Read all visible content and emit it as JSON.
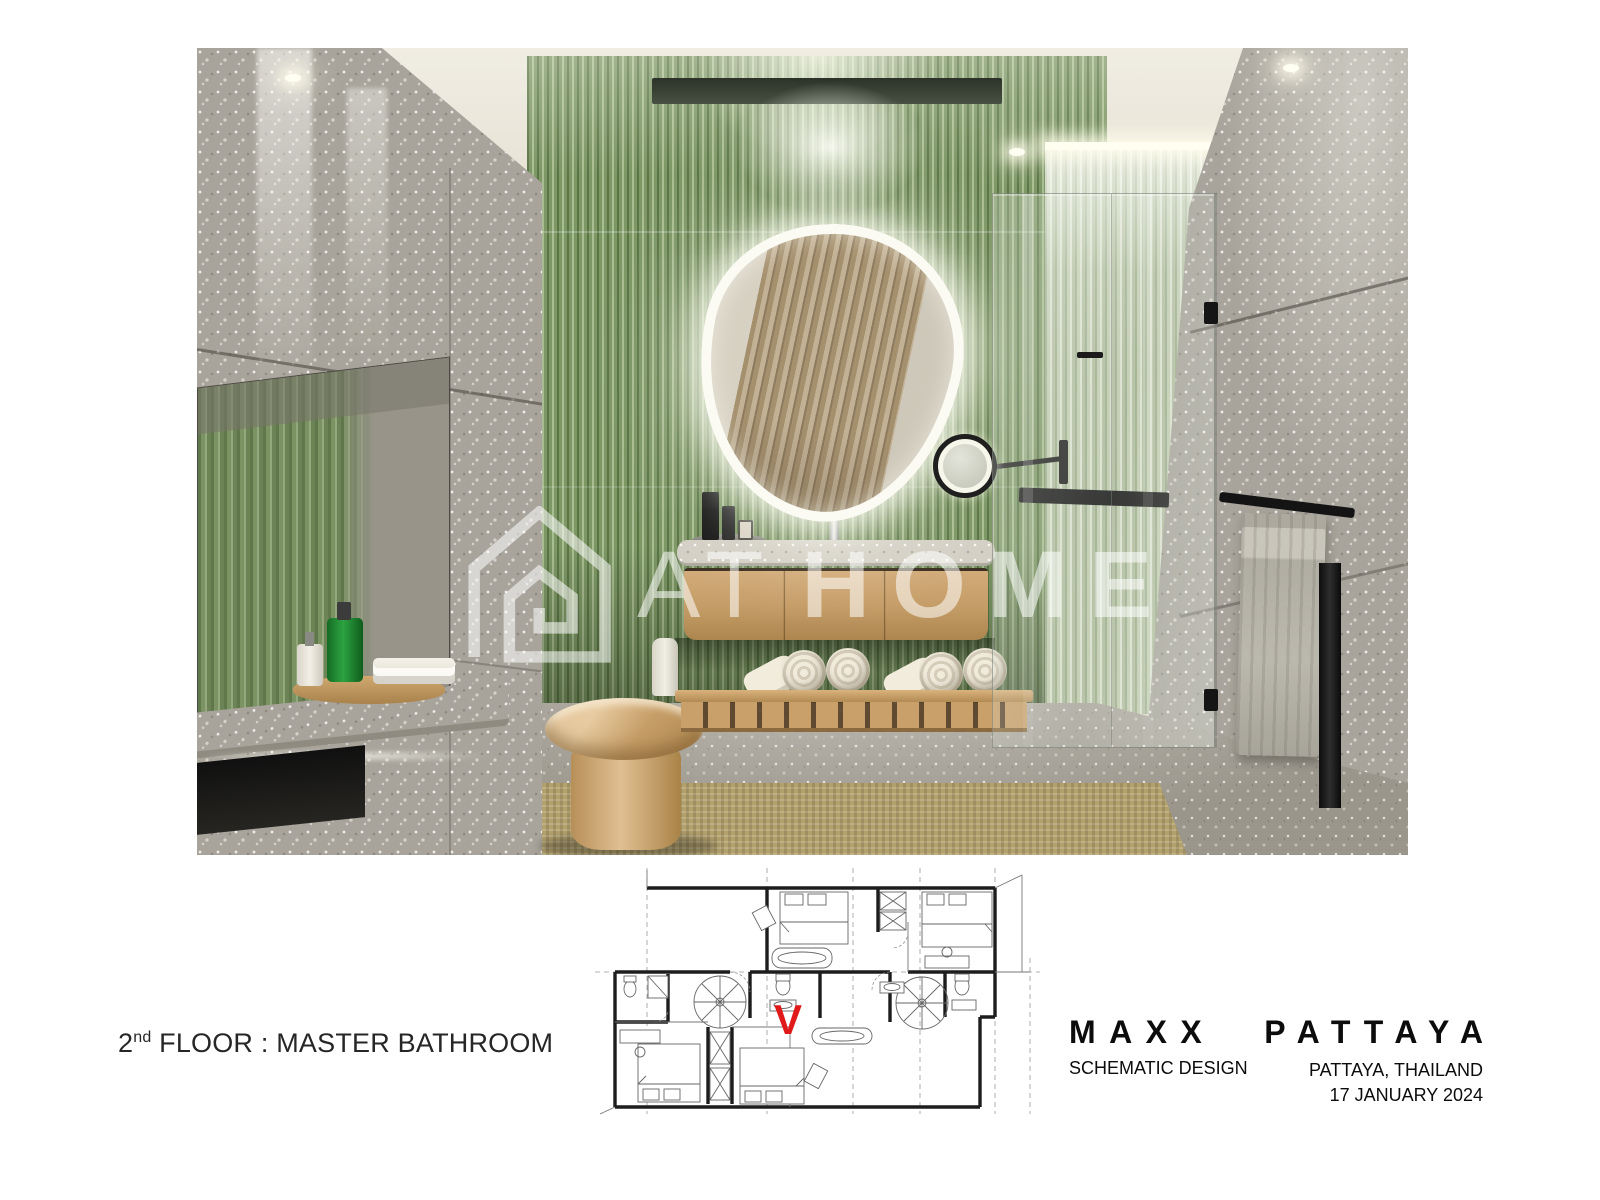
{
  "watermark": {
    "at": "AT",
    "home": "HOME"
  },
  "floor_plan": {
    "marker": "V"
  },
  "footer": {
    "floor_number": "2",
    "floor_ordinal": "nd",
    "floor_text": "FLOOR : MASTER BATHROOM",
    "project_word1": "MAXX",
    "project_word2": "PATTAYA",
    "phase": "SCHEMATIC DESIGN",
    "location": "PATTAYA, THAILAND",
    "date": "17 JANUARY 2024"
  },
  "colors": {
    "green": "#7d9765",
    "green-dark": "#5c7547",
    "green-light": "#a9bd92",
    "terrazzo": "#a8a49b",
    "terrazzo-light": "#c9c5bb",
    "ceiling": "#e8e4d9",
    "wood": "#c9a671",
    "wood-dark": "#9a7848",
    "floor": "#9b968c",
    "rug": "#b2a06d",
    "red": "#e01a1a",
    "ink": "#262626"
  }
}
